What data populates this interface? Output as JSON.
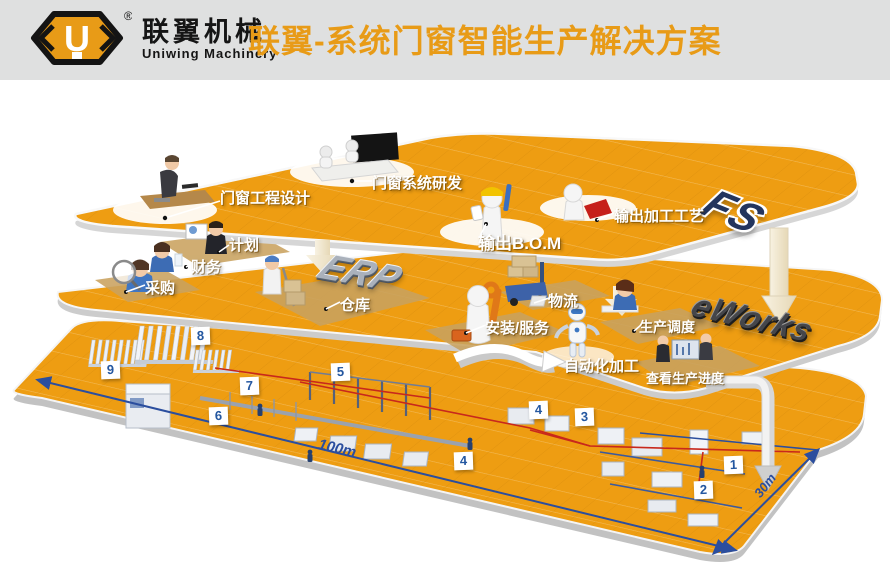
{
  "header": {
    "logo": {
      "letter": "U",
      "registered": "®",
      "name_cn": "联翼机械",
      "name_en": "Uniwing Machinery"
    },
    "title": "联翼-系统门窗智能生产解决方案"
  },
  "diagram": {
    "top_layer": {
      "system": "FS",
      "stations": [
        {
          "label": "门窗工程设计"
        },
        {
          "label": "门窗系统研发"
        },
        {
          "label": "输出B.O.M"
        },
        {
          "label": "输出加工工艺"
        }
      ]
    },
    "erp_layer": {
      "system": "ERP",
      "stations": [
        {
          "label": "计划"
        },
        {
          "label": "财务"
        },
        {
          "label": "采购"
        },
        {
          "label": "仓库"
        },
        {
          "label": "物流"
        },
        {
          "label": "安装/服务"
        }
      ]
    },
    "eworks_layer": {
      "system": "eWorks",
      "stations": [
        {
          "label": "生产调度"
        },
        {
          "label": "自动化加工"
        },
        {
          "label": "查看生产进度"
        }
      ]
    },
    "factory_floor": {
      "badges": [
        "1",
        "2",
        "3",
        "4",
        "4",
        "5",
        "6",
        "7",
        "8",
        "9"
      ],
      "dimensions": {
        "length": "100m",
        "width": "30m"
      }
    }
  },
  "colors": {
    "floor_orange": "#ee9d12",
    "title_orange": "#e89b17",
    "dimension_blue": "#2b4e9e",
    "pipe_red": "#c8281c",
    "header_gray": "#dfe0e0"
  }
}
